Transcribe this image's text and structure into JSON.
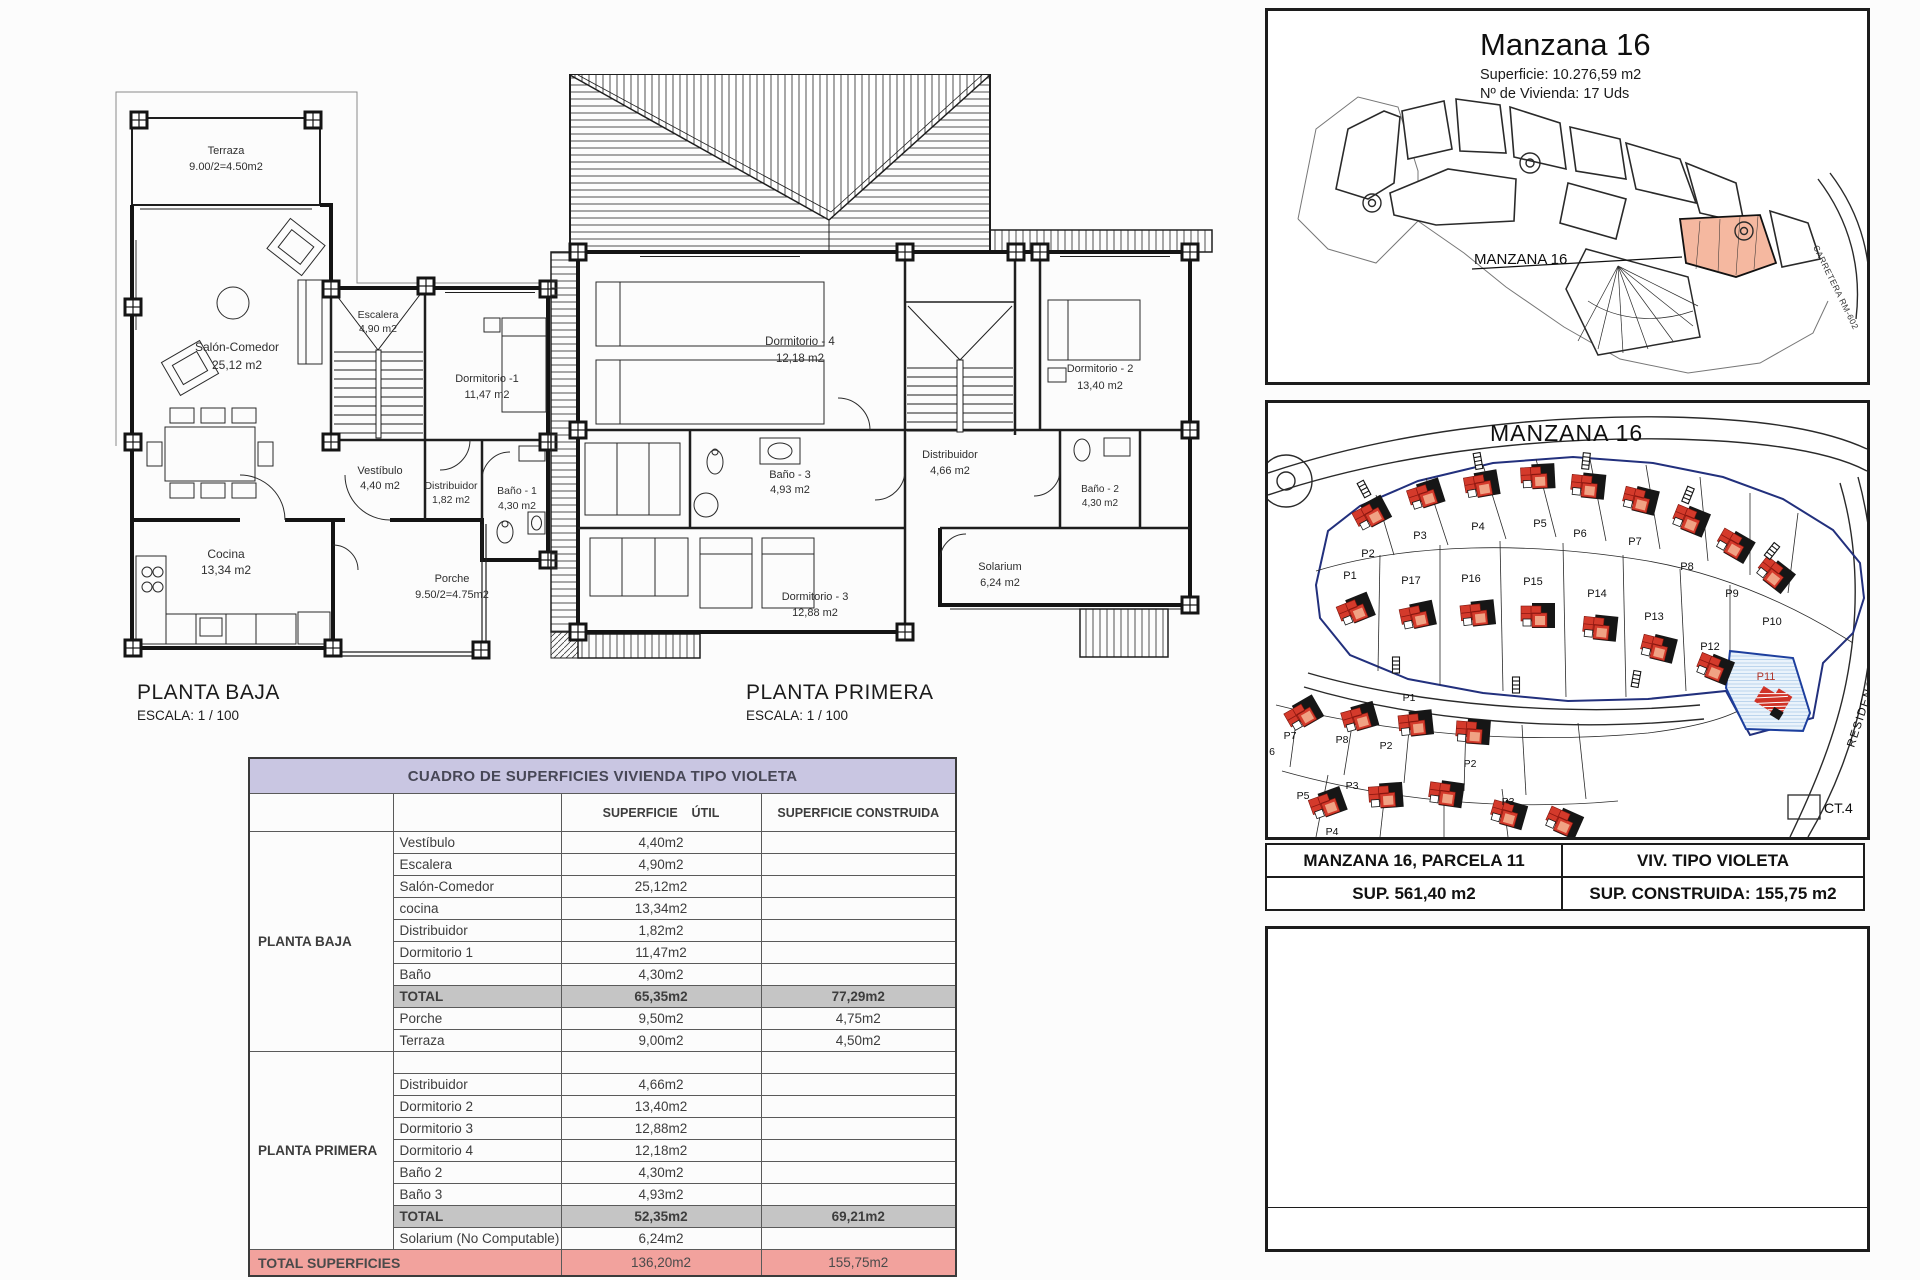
{
  "document": {
    "pb_caption": "PLANTA BAJA",
    "pb_scale": "ESCALA: 1 / 100",
    "pp_caption": "PLANTA PRIMERA",
    "pp_scale": "ESCALA: 1 / 100"
  },
  "floor_plans": {
    "planta_baja": {
      "rooms": [
        {
          "name": "Terraza",
          "area": "9.00/2=4.50m2"
        },
        {
          "name": "Salón-Comedor",
          "area": "25,12 m2"
        },
        {
          "name": "Escalera",
          "area": "4,90 m2"
        },
        {
          "name": "Dormitorio -1",
          "area": "11,47 m2"
        },
        {
          "name": "Vestíbulo",
          "area": "4,40 m2"
        },
        {
          "name": "Distribuidor",
          "area": "1,82 m2"
        },
        {
          "name": "Baño - 1",
          "area": "4,30 m2"
        },
        {
          "name": "Cocina",
          "area": "13,34 m2"
        },
        {
          "name": "Porche",
          "area": "9.50/2=4.75m2"
        }
      ]
    },
    "planta_primera": {
      "rooms": [
        {
          "name": "Dormitorio - 4",
          "area": "12,18 m2"
        },
        {
          "name": "Dormitorio - 2",
          "area": "13,40 m2"
        },
        {
          "name": "Baño - 3",
          "area": "4,93 m2"
        },
        {
          "name": "Distribuidor",
          "area": "4,66 m2"
        },
        {
          "name": "Baño - 2",
          "area": "4,30 m2"
        },
        {
          "name": "Dormitorio - 3",
          "area": "12,88 m2"
        },
        {
          "name": "Solarium",
          "area": "6,24 m2"
        }
      ]
    }
  },
  "surface_table": {
    "title": "CUADRO DE SUPERFICIES  VIVIENDA TIPO VIOLETA",
    "col_util": "SUPERFICIE    ÚTIL",
    "col_construida": "SUPERFICIE CONSTRUIDA",
    "planta_baja_group": "PLANTA BAJA",
    "planta_baja_rows": [
      {
        "room": "Vestíbulo",
        "util": "4,40m2",
        "cons": ""
      },
      {
        "room": "Escalera",
        "util": "4,90m2",
        "cons": ""
      },
      {
        "room": "Salón-Comedor",
        "util": "25,12m2",
        "cons": ""
      },
      {
        "room": "cocina",
        "util": "13,34m2",
        "cons": ""
      },
      {
        "room": "Distribuidor",
        "util": "1,82m2",
        "cons": ""
      },
      {
        "room": "Dormitorio 1",
        "util": "11,47m2",
        "cons": ""
      },
      {
        "room": "Baño",
        "util": "4,30m2",
        "cons": ""
      },
      {
        "room": "TOTAL",
        "util": "65,35m2",
        "cons": "77,29m2"
      },
      {
        "room": "Porche",
        "util": "9,50m2",
        "cons": "4,75m2"
      },
      {
        "room": "Terraza",
        "util": "9,00m2",
        "cons": "4,50m2"
      }
    ],
    "planta_primera_group": "PLANTA PRIMERA",
    "planta_primera_rows": [
      {
        "room": "Distribuidor",
        "util": "4,66m2",
        "cons": ""
      },
      {
        "room": "Dormitorio 2",
        "util": "13,40m2",
        "cons": ""
      },
      {
        "room": "Dormitorio 3",
        "util": "12,88m2",
        "cons": ""
      },
      {
        "room": "Dormitorio 4",
        "util": "12,18m2",
        "cons": ""
      },
      {
        "room": "Baño 2",
        "util": "4,30m2",
        "cons": ""
      },
      {
        "room": "Baño 3",
        "util": "4,93m2",
        "cons": ""
      },
      {
        "room": "TOTAL",
        "util": "52,35m2",
        "cons": "69,21m2"
      },
      {
        "room": "Solarium (No Computable)",
        "util": "6,24m2",
        "cons": ""
      }
    ],
    "total_label": "TOTAL SUPERFICIES",
    "total_util": "136,20m2",
    "total_construida": "155,75m2"
  },
  "site_overview": {
    "title": "Manzana 16",
    "superficie": "Superficie:  10.276,59 m2",
    "viviendas": "Nº de Vivienda: 17 Uds",
    "block_label": "MANZANA 16",
    "road_label": "CARRETERA RM-602"
  },
  "site_detail": {
    "title": "MANZANA 16",
    "parcels_top": [
      "P2",
      "P3",
      "P4",
      "P5",
      "P6",
      "P7",
      "P8",
      "P9",
      "P10"
    ],
    "parcels_row2": [
      "P1",
      "P17",
      "P16",
      "P15",
      "P14",
      "P13",
      "P12",
      "P11"
    ],
    "parcels_lower": [
      "6",
      "P7",
      "P8",
      "P2",
      "P1",
      "P3",
      "P5",
      "P4",
      "P2",
      "P3"
    ],
    "ct_label": "CT.4",
    "residencial_label": "RESIDENCIAL CO"
  },
  "info_tables": {
    "parcela": "MANZANA 16, PARCELA 11",
    "tipo": "VIV. TIPO VIOLETA",
    "sup": "SUP. 561,40 m2",
    "sup_construida": "SUP. CONSTRUIDA: 155,75 m2"
  }
}
